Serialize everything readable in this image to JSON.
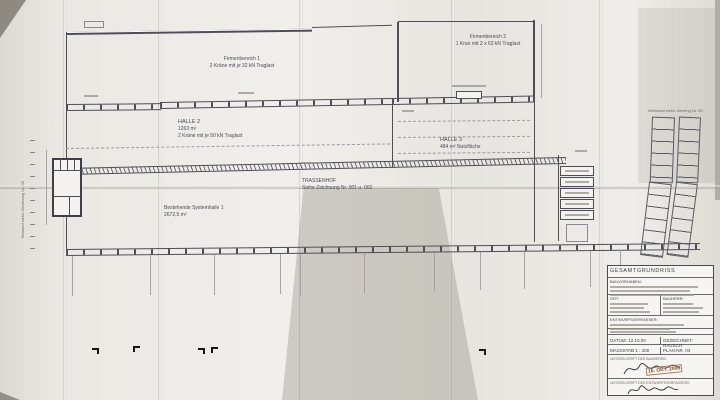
{
  "plan": {
    "area1": {
      "line1": "Firmenbereich 1",
      "line2": "2 Kräne mit je 32 kN Traglast"
    },
    "halle2": {
      "line1": "HALLE 2",
      "line2": "1263 m²",
      "line3": "2 Kräne mit je 50 kN Traglast"
    },
    "area2": {
      "line1": "Firmenbereich 2",
      "line2": "1 Kran mit 2 x 63 kN Traglast"
    },
    "halle3": {
      "line1": "HALLE 3",
      "line2": "484 m² Nutzfläche"
    },
    "trassenhof": {
      "line1": "TRASSENHOF",
      "line2": "Siehe Zeichnung Nr. 001 u. 002"
    },
    "systemhalle": {
      "line1": "Bestehende Systemhalle 1",
      "line2": "2672,5 m²"
    },
    "left_margin_note": "Bestand siehe Zeichnung Nr. 06",
    "right_margin_note": "Werkstatt siehe Zeichng Nr. 05"
  },
  "title_block": {
    "title": "GESAMTGRUNDRISS",
    "bauvorhaben_label": "BAUVORHABEN:",
    "ort_label": "ORT:",
    "bauherr_label": "BAUHERR:",
    "entwurfsverfasser_label": "ENTWURFSVERFASSER:",
    "datum_label": "DATUM:",
    "datum_value": "12.10.00",
    "gezeichnet_label": "GEZEICHNET:",
    "gezeichnet_value": "RAUSCH",
    "massstab_label": "MASSSTAB 1 :",
    "massstab_value": "200",
    "plan_nr_label": "PLAN-NR.",
    "plan_nr_value": "03",
    "sign_bauherr_label": "UNTERSCHRIFT DES BAUHERRN",
    "sign_verfasser_label": "UNTERSCHRIFT DES ENTWURFSVERFASSERS",
    "stamp_date": "16. OKT. 2000"
  },
  "colors": {
    "paper": "#e9e7e2",
    "line": "#4e4e58",
    "stamp": "#8a4a2a"
  }
}
